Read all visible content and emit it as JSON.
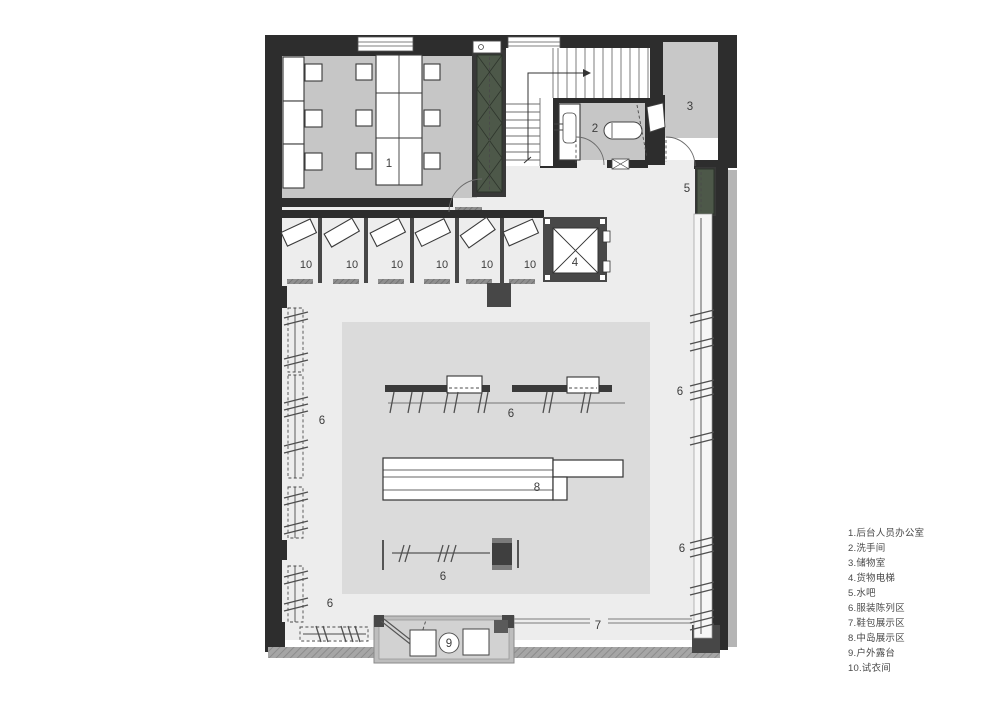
{
  "plan": {
    "room_labels": {
      "office": "1",
      "restroom": "2",
      "storage": "3",
      "cargo_elevator": "4",
      "water_bar": "5",
      "clothing_display": "6",
      "shoe_bag_display": "7",
      "island_display": "8",
      "terrace": "9",
      "fitting_room": "10"
    }
  },
  "legend": {
    "items": [
      "1.后台人员办公室",
      "2.洗手间",
      "3.储物室",
      "4.货物电梯",
      "5.水吧",
      "6.服装陈列区",
      "7.鞋包展示区",
      "8.中岛展示区",
      "9.户外露台",
      "10.试衣间"
    ]
  },
  "colors": {
    "wall": "#2d2d2d",
    "room_floor": "#c6c6c6",
    "main_floor": "#ededed",
    "center_zone": "#dbdbdb",
    "terrace_floor": "#d2d2d2",
    "cabinet_green": "#4d5849",
    "hatch_wall": "#a6a6a6"
  }
}
